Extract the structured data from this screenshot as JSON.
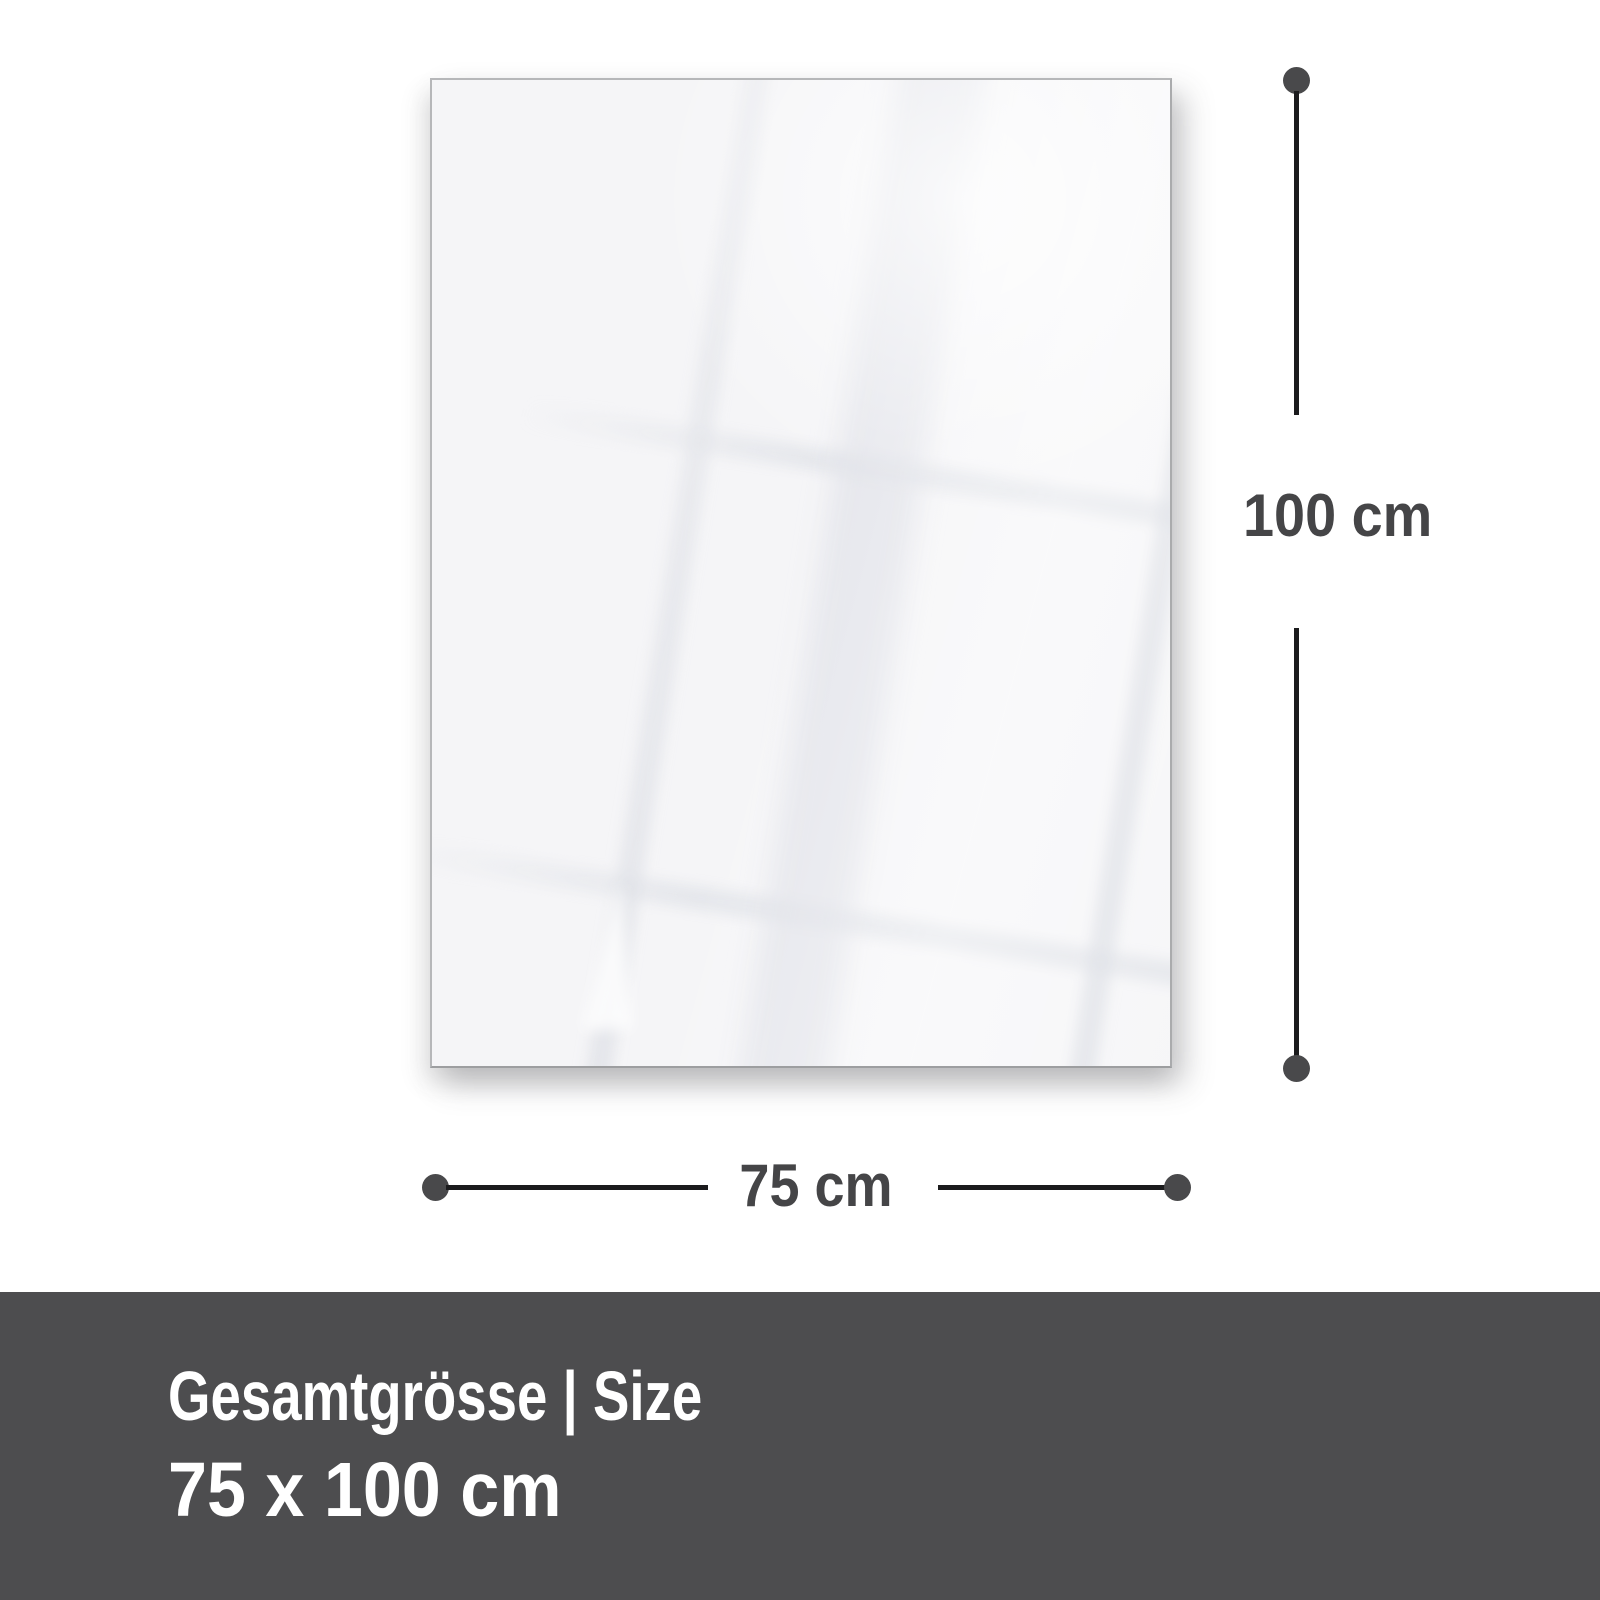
{
  "panel": {
    "type": "blank glossy product panel",
    "fill_color": "#f5f5f7",
    "border_color": "#b6b7b9"
  },
  "dimensions": {
    "height_label": "100 cm",
    "width_label": "75 cm",
    "line_color": "#1b1b1d",
    "dot_color": "#49494b",
    "label_color": "#454547"
  },
  "footer": {
    "title": "Gesamtgrösse | Size",
    "size": "75 x 100 cm",
    "background": "#4d4d4f",
    "text_color": "#ffffff"
  }
}
